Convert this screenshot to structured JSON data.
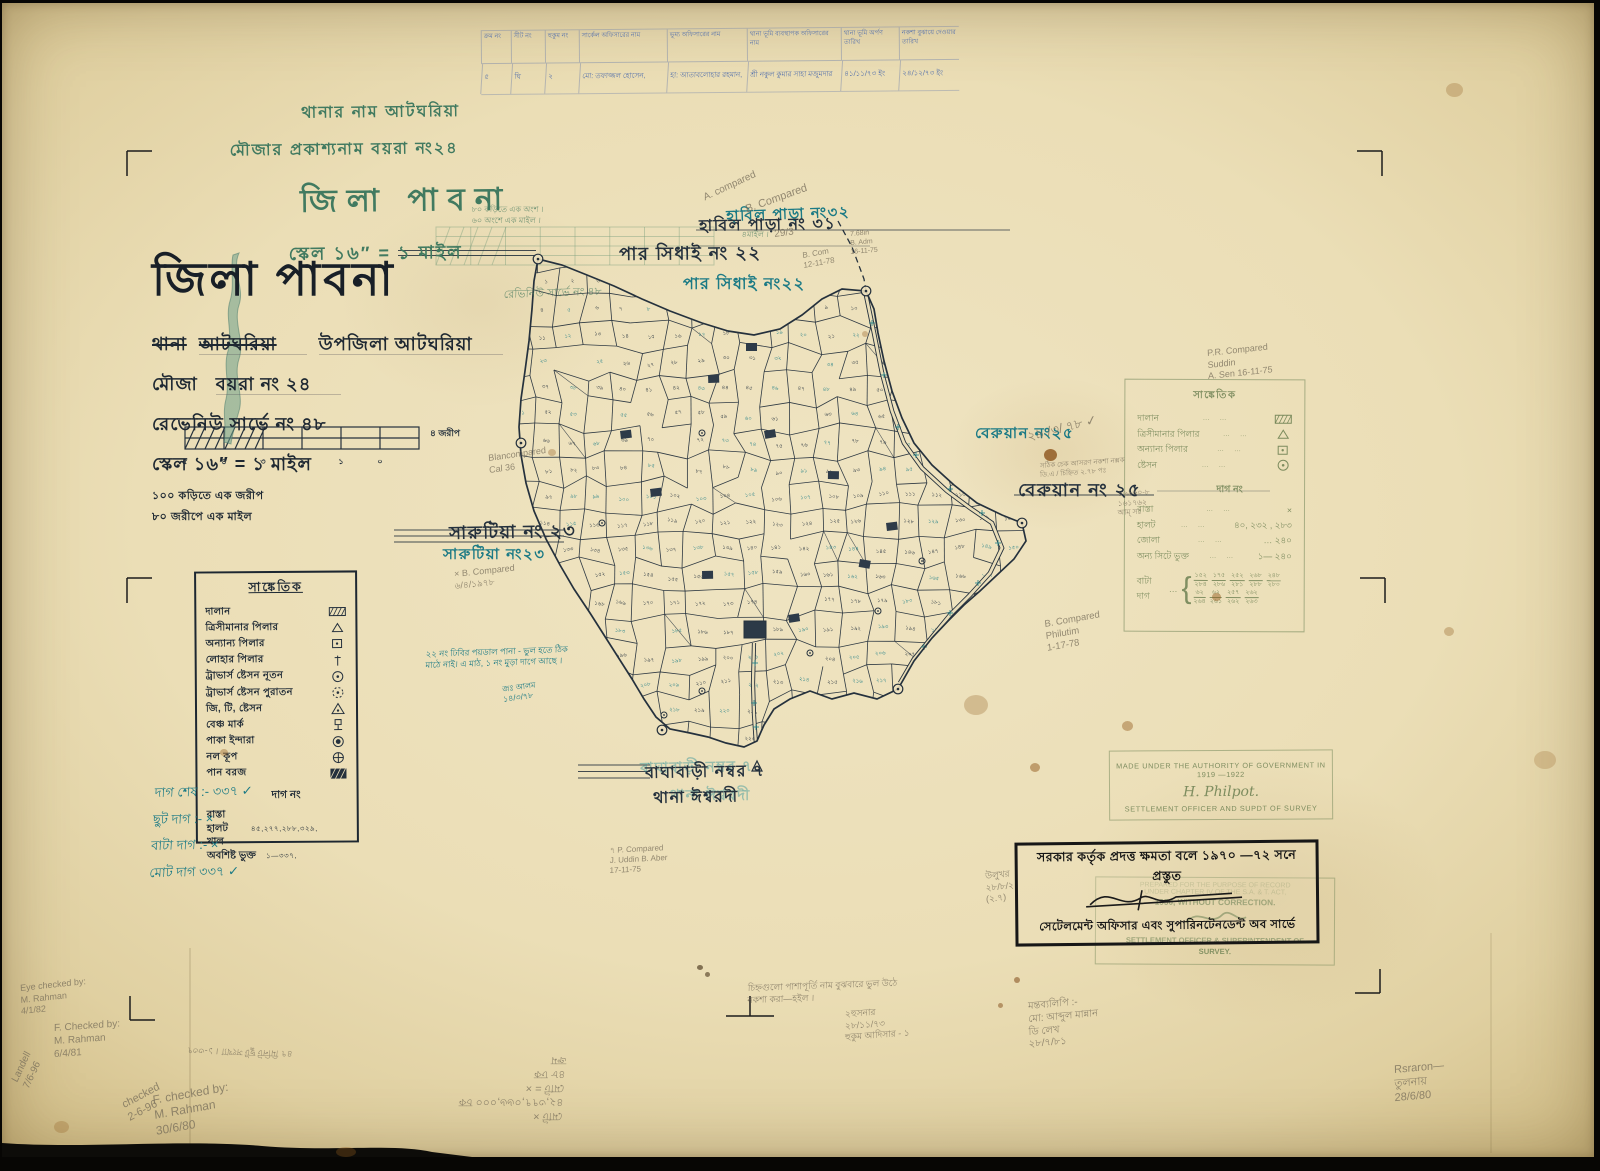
{
  "top_table": {
    "headers": [
      "ক্রম নং",
      "সীট নং",
      "হুকুম নং",
      "সার্কেল অফিসারের নাম",
      "ভূম্য অফিসারের নাম",
      "থানা ভূমি ব্যবস্থাপক অফিসারের নাম",
      "থানা ভূমি অর্পণ তারিখ",
      "নকশা বুঝায়ে দেওয়ার তারিখ"
    ],
    "row": [
      "৫",
      "ঘি",
      "২",
      "মো: তফাজ্জল হোসেন,",
      "হা: আতাবলোহার রহমান,",
      "শ্রী নকুল কুমার সাহা মজুমদার",
      "৪১/১১/৭৩ ইং",
      "২৪/১২/৭৩ ইং"
    ],
    "col_widths": [
      30,
      34,
      34,
      88,
      80,
      94,
      58,
      60
    ]
  },
  "green_header": {
    "line1": "থানার নাম   আটঘরিয়া",
    "line2": "মৌজার প্রকাশ্যনাম   বয়রা নং২৪",
    "title": "জিলা  পাবনা",
    "scale": "স্কেল ১৬″ = ১ মাইল"
  },
  "title_block": {
    "title": "জিলা পাবনা",
    "thana_label": "থানা",
    "thana_struck": "আটঘরিয়া",
    "thana_value": "উপজিলা আটঘরিয়া",
    "mouza_label": "মৌজা",
    "mouza_value": "বয়রা নং ২৪",
    "revenue": "রেভেনিউ সার্ভে নং ৪৮",
    "scale": "স্কেল ১৬″ = ১ মাইল",
    "conv1": "১০০ কড়িতে এক জরীপ",
    "conv2": "৮০ জরীপে এক মাইল",
    "scalebar": {
      "numbers": [
        "৫",
        "৪",
        "৩",
        "২",
        "১",
        "০"
      ],
      "unit": "৪ জরীপ"
    }
  },
  "legend": {
    "title": "সাঙ্কেতিক",
    "items": [
      {
        "label": "দালান",
        "sym": "hatch"
      },
      {
        "label": "ত্রিসীমানার পিলার",
        "sym": "tri"
      },
      {
        "label": "অন্যান্য পিলার",
        "sym": "sqdot"
      },
      {
        "label": "লোহার পিলার",
        "sym": "post"
      },
      {
        "label": "ট্রাভার্স ষ্টেসন নূতন",
        "sym": "cdot"
      },
      {
        "label": "ট্রাভার্স ষ্টেসন পুরাতন",
        "sym": "cdash"
      },
      {
        "label": "জি, টি, ষ্টেসন",
        "sym": "tridot"
      },
      {
        "label": "বেঞ্চ মার্ক",
        "sym": "bench"
      },
      {
        "label": "পাকা ইন্দারা",
        "sym": "well"
      },
      {
        "label": "নল কূপ",
        "sym": "tube"
      },
      {
        "label": "পান বরজ",
        "sym": "hatchfill"
      }
    ],
    "dag_heading": "দাগ নং",
    "dag_rows": [
      {
        "label": "রাস্তা",
        "value": ""
      },
      {
        "label": "হালট",
        "value": "৪৫,২৭৭,২৮৮,৩২৯,"
      },
      {
        "label": "খাল",
        "value": ""
      },
      {
        "label": "অবশিষ্ট ভুক্ত",
        "value": "১—৩৩৭,"
      }
    ]
  },
  "tally": {
    "lines": [
      "দাগ  শেষ :-   ৩৩৭ ✓",
      "ছুট দাগ :-     ×",
      "বাটা দাগ :-    ×",
      "মোট দাগ    ৩৩৭ ✓"
    ]
  },
  "green_legend": {
    "title": "সাঙ্কেতিক",
    "rows": [
      {
        "label": "দালান",
        "sym": "hatch",
        "value": ""
      },
      {
        "label": "ত্রিসীমানার পিলার",
        "sym": "tri",
        "value": ""
      },
      {
        "label": "অন্যান্য পিলার",
        "sym": "sqdot",
        "value": ""
      },
      {
        "label": "ষ্টেসন",
        "sym": "cdot",
        "value": ""
      }
    ],
    "dag_heading": "দাগ নং",
    "dag_rows": [
      {
        "label": "রাস্তা",
        "value": "×"
      },
      {
        "label": "হালট",
        "value": "৪০,   ২৩২ ,  ২৮৩"
      },
      {
        "label": "জোলা",
        "value": "… ২৪০"
      },
      {
        "label": "অন্য সিটে ভুক্ত",
        "value": "১—  ২৪০"
      }
    ],
    "bata_label": "বাটা দাগ",
    "fractions": [
      {
        "nu": "১৫২",
        "de": "২৮৪"
      },
      {
        "nu": "১৭৫",
        "de": "২৮৬"
      },
      {
        "nu": "২৫২",
        "de": "২৮১"
      },
      {
        "nu": "২৬৮",
        "de": "২৮৮"
      },
      {
        "nu": "২৪৮",
        "de": "২৮০"
      },
      {
        "nu": "৬২",
        "de": "২৬৪"
      },
      {
        "nu": "৬২",
        "de": "২৬১"
      },
      {
        "nu": "২৫৭",
        "de": "২৬২"
      },
      {
        "nu": "২৬২",
        "de": "২৬৩"
      }
    ]
  },
  "stamps": {
    "en": {
      "line1": "MADE UNDER THE AUTHORITY OF GOVERNMENT IN 1919 —1922",
      "sig": "H. Philpot.",
      "line2": "SETTLEMENT OFFICER AND SUPDT OF SURVEY"
    },
    "bn": {
      "line1": "সরকার কর্তৃক প্রদত্ত ক্ষমতা বলে ১৯৭০ —৭২ সনে প্রস্তুত",
      "line2": "সেটেলমেন্ট অফিসার এবং সুপারিনটেনডেন্ট অব সার্ভে"
    },
    "overlay": {
      "l1": "PREPARED FOR THE PURPOSE OF RECORD",
      "l2": "UNDER CHAPTER IV OF THE S.A. & T. ACT,",
      "l3": "1950, WITHOUT CORRECTION.",
      "l4": "SETTLEMENT OFFICER & SUPERINTENDENT OF",
      "l5": "SURVEY."
    }
  },
  "map": {
    "total_plots": 337,
    "bengali_digits": "০১২৩৪৫৬৭৮৯",
    "labels": [
      {
        "text": "পার সিধাই নং ২২",
        "c": "ink",
        "x": 617,
        "y": 240,
        "s": 18,
        "r": -0.5
      },
      {
        "text": "পার সিধাই নং২২",
        "c": "teal",
        "x": 681,
        "y": 272,
        "s": 16,
        "r": 0
      },
      {
        "text": "হাবিল পাড়া নং৩২",
        "c": "teal",
        "x": 724,
        "y": 204,
        "s": 15,
        "r": -2
      },
      {
        "text": "হাবিল পাড়া নং ৩১",
        "c": "ink",
        "x": 697,
        "y": 214,
        "s": 16,
        "r": -1
      },
      {
        "text": "সারুটিয়া নং ২৩",
        "c": "ink",
        "x": 447,
        "y": 519,
        "s": 18,
        "r": -1
      },
      {
        "text": "সারুটিয়া নং২৩",
        "c": "teal",
        "x": 441,
        "y": 542,
        "s": 15,
        "r": 0
      },
      {
        "text": "বেরুয়ান নং২৫",
        "c": "teal",
        "x": 973,
        "y": 421,
        "s": 15,
        "r": 0
      },
      {
        "text": "বেরুয়ান নং ২৫",
        "c": "ink",
        "x": 1016,
        "y": 476,
        "s": 18,
        "r": 0
      },
      {
        "text": "বাঘাবাড়ী নম্বর ৭",
        "c": "teal-ghost",
        "x": 638,
        "y": 756,
        "s": 15,
        "r": -1
      },
      {
        "text": "বাঘাবাড়ী নম্বর ৭",
        "c": "ink",
        "x": 643,
        "y": 761,
        "s": 16,
        "r": -1
      },
      {
        "text": "থানা ঈশ্বরদী",
        "c": "teal-ghost",
        "x": 668,
        "y": 783,
        "s": 15,
        "r": 0
      },
      {
        "text": "থানা ঈশ্বরদী",
        "c": "ink",
        "x": 651,
        "y": 786,
        "s": 16,
        "r": -1
      }
    ]
  },
  "annotations": [
    {
      "t": "৮০ কড়িতে এক অংশ ।",
      "x": 470,
      "y": 202,
      "s": 8,
      "r": 0,
      "c": "green"
    },
    {
      "t": "৬০ অংশে এক মাইল ।",
      "x": 470,
      "y": 213,
      "s": 8,
      "r": 0,
      "c": "green"
    },
    {
      "t": "৪মাইল ।",
      "x": 740,
      "y": 227,
      "s": 8,
      "r": 0,
      "c": "green"
    },
    {
      "t": "রেভিনিউ সার্ভে নং ৪৮",
      "x": 502,
      "y": 285,
      "s": 11,
      "r": -2,
      "c": "green"
    },
    {
      "t": "A. compared",
      "x": 700,
      "y": 190,
      "s": 10,
      "r": -25,
      "c": "pencil"
    },
    {
      "t": "B. Compared",
      "x": 742,
      "y": 200,
      "s": 11,
      "r": -20,
      "c": "pencil"
    },
    {
      "t": "29/3",
      "x": 772,
      "y": 226,
      "s": 10,
      "r": -8,
      "c": "pencil"
    },
    {
      "t": "7.68in\nB. Adm\n16-11-75",
      "x": 848,
      "y": 228,
      "s": 7,
      "r": -5,
      "c": "pencil"
    },
    {
      "t": "B. Com\n12-11-78",
      "x": 800,
      "y": 248,
      "s": 8,
      "r": -10,
      "c": "pencil"
    },
    {
      "t": "P.R. Compared\nSuddin\nA. Sen  16-11-75",
      "x": 1205,
      "y": 345,
      "s": 9,
      "r": -6,
      "c": "pencil"
    },
    {
      "t": "২৯ /৩/ ৭৮ ✓",
      "x": 1024,
      "y": 426,
      "s": 13,
      "r": -14,
      "c": "pencil"
    },
    {
      "t": "সঠিক চেক  আসরণ নকশা নক্সক\nডি.এ / চিহ্নিত   ২.৭৮ পঃ",
      "x": 1038,
      "y": 460,
      "s": 7,
      "r": -4,
      "c": "pencil"
    },
    {
      "t": "১৬৯৬০-৮\n১৬১৭৬২\nআম্ সঃ",
      "x": 1116,
      "y": 486,
      "s": 7.5,
      "r": -3,
      "c": "pencil"
    },
    {
      "t": "B. Compared\nPhilutim\n1-17-78",
      "x": 1042,
      "y": 616,
      "s": 9.5,
      "r": -10,
      "c": "pencil"
    },
    {
      "t": "Blancompared\nCal 36",
      "x": 486,
      "y": 450,
      "s": 9,
      "r": -8,
      "c": "pencil"
    },
    {
      "t": "× B. Compared\n৬/৪/১৯৭৮",
      "x": 452,
      "y": 566,
      "s": 9,
      "r": -6,
      "c": "pencil"
    },
    {
      "t": "২২ নং ঢিবির পয়ডাল পানা - ভুল হতে ঠিক\nমাঠে নাই। এ মাঠ, ১ নং মুড়া দাগে আছে ।",
      "x": 424,
      "y": 646,
      "s": 8.5,
      "r": -2,
      "c": "teal"
    },
    {
      "t": "জঃ আলম\n১৪/৩/৭৮",
      "x": 500,
      "y": 682,
      "s": 8,
      "r": -8,
      "c": "teal"
    },
    {
      "t": "৭ P. Compared\nJ. Uddin     B. Aber\n17-11-75",
      "x": 608,
      "y": 843,
      "s": 8,
      "r": -3,
      "c": "pencil"
    },
    {
      "t": "চিহ্নগুলো  পাশাপূর্তি নাম বুঝবারে ভুল উঠে\nনকশা  করা—হইল ।",
      "x": 746,
      "y": 980,
      "s": 9,
      "r": -2,
      "c": "pencil"
    },
    {
      "t": "২হুসনার\n২৮/১১/৭৩\nহুকুম আদিসার - ১",
      "x": 843,
      "y": 1006,
      "s": 9,
      "r": -4,
      "c": "pencil"
    },
    {
      "t": "মন্তব্যলিপি :-\nমো:  আব্দুল  মান্নান\nডি  লেখ\n২৮/৭/৮১",
      "x": 1026,
      "y": 998,
      "s": 10,
      "r": -5,
      "c": "pencil"
    },
    {
      "t": "উলুখর\n২৮/৮/২\n(২.৭)",
      "x": 983,
      "y": 868,
      "s": 9,
      "r": -6,
      "c": "pencil"
    },
    {
      "t": "Eye checked by:\nM. Rahman\n4/1/82",
      "x": 18,
      "y": 980,
      "s": 9,
      "r": -6,
      "c": "pencil"
    },
    {
      "t": "F. Checked by:\nM. Rahman\n6/4/81",
      "x": 52,
      "y": 1020,
      "s": 10,
      "r": -4,
      "c": "pencil"
    },
    {
      "t": "checked\n2-6-96",
      "x": 118,
      "y": 1096,
      "s": 11,
      "r": -28,
      "c": "pencil"
    },
    {
      "t": "F. checked by:\nM. Rahman\n30/6/80",
      "x": 150,
      "y": 1090,
      "s": 12,
      "r": -10,
      "c": "pencil"
    },
    {
      "t": "Landell\n7/6-96",
      "x": 8,
      "y": 1076,
      "s": 10,
      "r": -65,
      "c": "pencil"
    },
    {
      "t": "মোট  ×\n৪২,৩৭৭,০৬৬,০০০  চক\nমোট = ×\n৪৮  ঢক\nক্রম",
      "x": 560,
      "y": 1120,
      "s": 11,
      "r": 180,
      "c": "pencil"
    },
    {
      "t": "৪৭ মিনিট ছুট সংখ্যা । ১-৩৩৭",
      "x": 290,
      "y": 1056,
      "s": 9,
      "r": 182,
      "c": "pencil"
    },
    {
      "t": "Rsraron—\nতুলনায়\n28/6/80",
      "x": 1392,
      "y": 1060,
      "s": 11,
      "r": -5,
      "c": "pencil"
    }
  ]
}
